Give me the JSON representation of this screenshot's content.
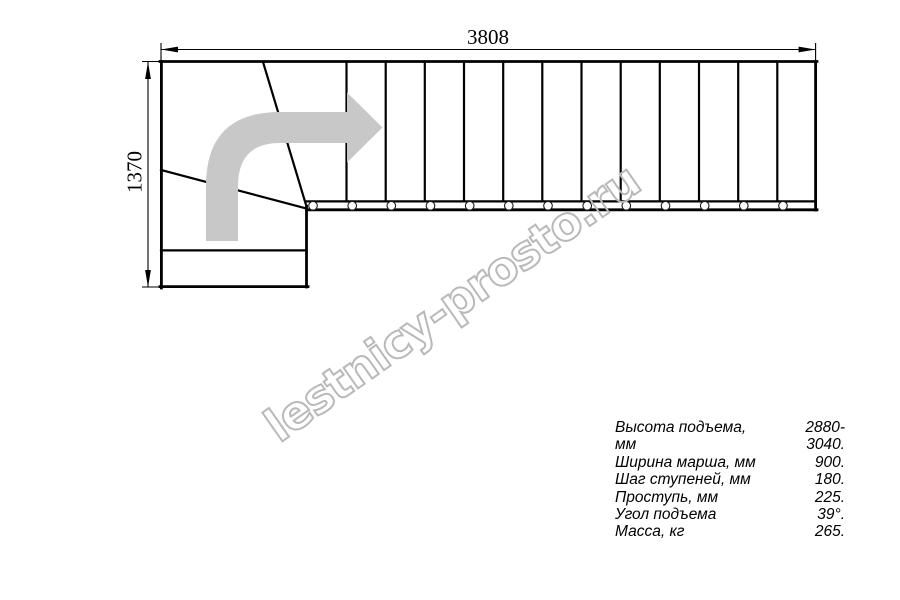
{
  "drawing": {
    "dimension_width": "3808",
    "dimension_height": "1370"
  },
  "watermark": {
    "text": "lestnicy-prosto.ru"
  },
  "specs": {
    "rows": [
      {
        "label": "Высота подъема, мм",
        "value": "2880-3040."
      },
      {
        "label": "Ширина марша, мм",
        "value": "900."
      },
      {
        "label": "Шаг ступеней, мм",
        "value": "180."
      },
      {
        "label": "Проступь, мм",
        "value": "225."
      },
      {
        "label": "Угол подъема",
        "value": "39°."
      },
      {
        "label": "Масса, кг",
        "value": "265."
      }
    ]
  },
  "colors": {
    "line": "#000000",
    "arrow_gray": "#c8c8c8",
    "watermark_gray": "#b9b9b9"
  }
}
